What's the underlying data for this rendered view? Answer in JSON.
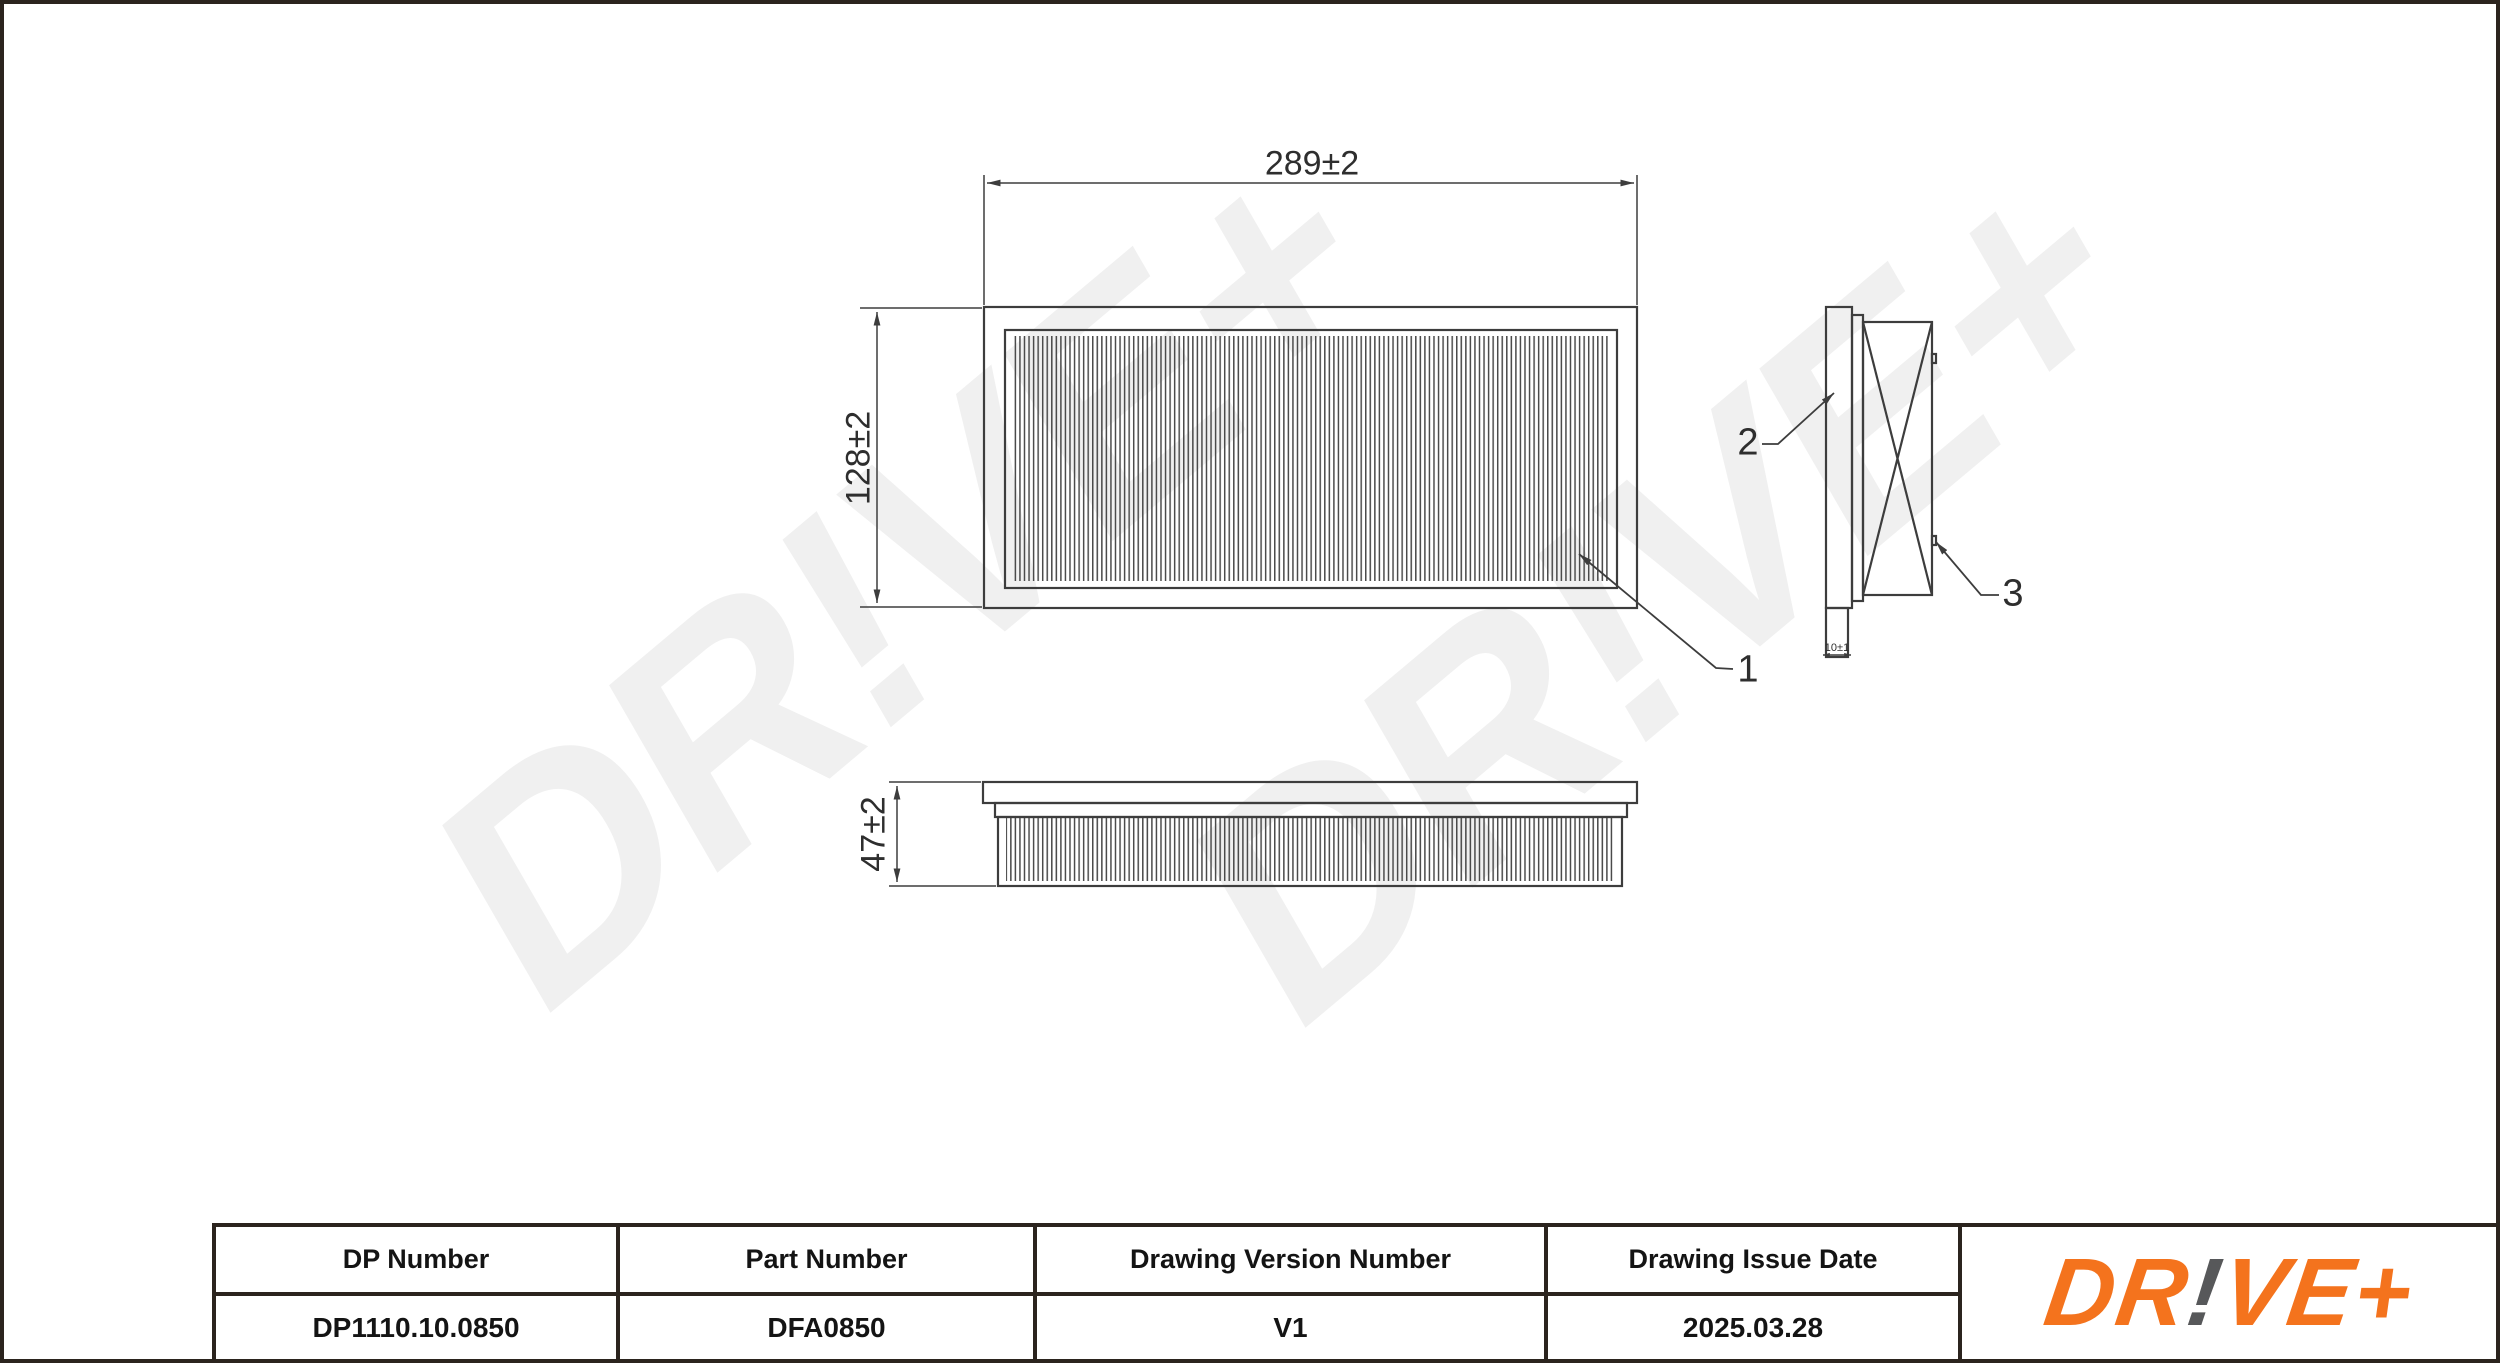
{
  "watermark": {
    "text": "DR!VE+",
    "color": "#f0f0f0"
  },
  "views": {
    "top": {
      "width_dim": "289±2",
      "height_dim": "128±2"
    },
    "front": {
      "height_dim": "47±2"
    },
    "side": {
      "tab_dim": "10±1"
    }
  },
  "callouts": {
    "c1": "1",
    "c2": "2",
    "c3": "3"
  },
  "title_block": {
    "columns": [
      {
        "label": "DP Number",
        "value": "DP1110.10.0850"
      },
      {
        "label": "Part Number",
        "value": "DFA0850"
      },
      {
        "label": "Drawing Version Number",
        "value": "V1"
      },
      {
        "label": "Drawing Issue Date",
        "value": "2025.03.28"
      }
    ]
  },
  "logo": {
    "segments": [
      {
        "text": "DR"
      },
      {
        "text": "!"
      },
      {
        "text": "VE+"
      }
    ],
    "orange": "#f4731d",
    "gray": "#57585a"
  },
  "colors": {
    "line": "#3d3d3d",
    "border": "#2b241e",
    "pleat": "#4b4b4b"
  }
}
